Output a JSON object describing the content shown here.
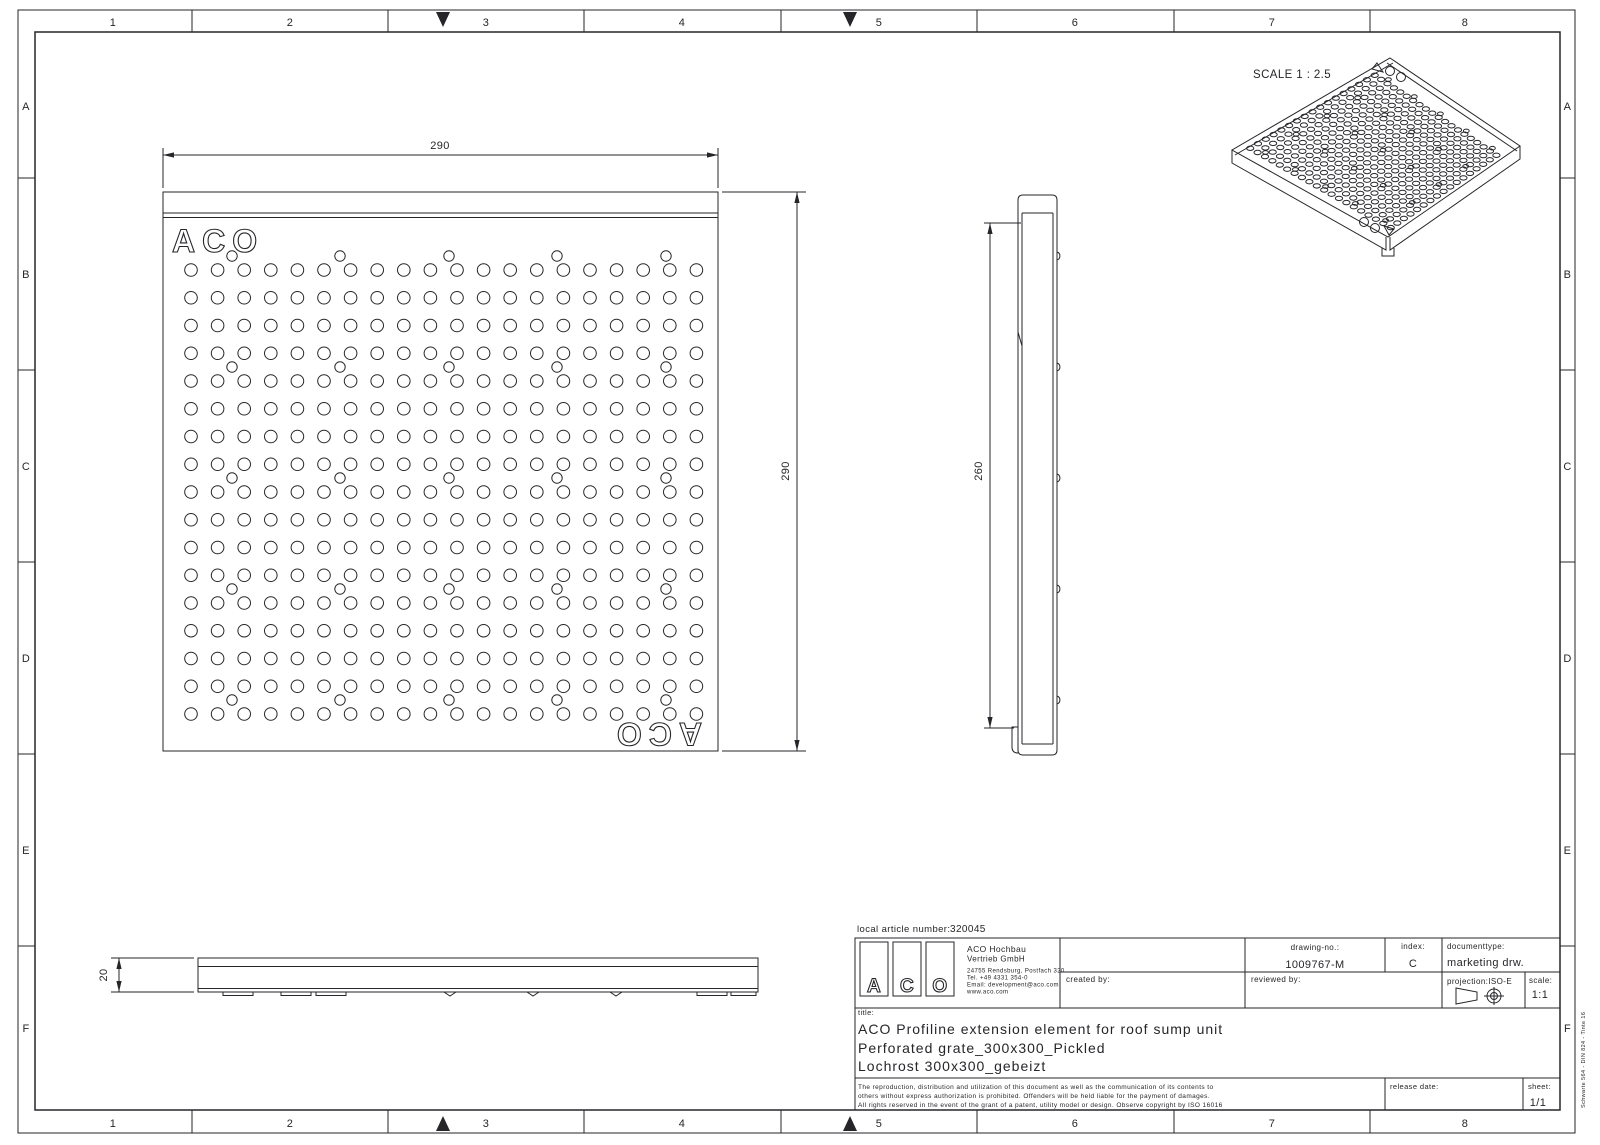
{
  "border": {
    "columns": [
      "1",
      "2",
      "3",
      "4",
      "5",
      "6",
      "7",
      "8"
    ],
    "rows": [
      "A",
      "B",
      "C",
      "D",
      "E",
      "F"
    ]
  },
  "iso_view": {
    "scale_label": "SCALE 1 : 2.5"
  },
  "plan_view": {
    "logo_text": "ACO",
    "width_dim": "290",
    "height_dim": "290"
  },
  "side_view": {
    "height_dim": "260"
  },
  "front_view": {
    "thickness_dim": "20"
  },
  "title_block": {
    "article_label": "local article number:",
    "article_value": "320045",
    "logo_letters": [
      "A",
      "C",
      "O"
    ],
    "company_line1": "ACO Hochbau",
    "company_line2": "Vertrieb GmbH",
    "address_lines": [
      "24755 Rendsburg, Postfach 320",
      "Tel. +49 4331 354-0",
      "Email: development@aco.com",
      "www.aco.com"
    ],
    "created_label": "created by:",
    "reviewed_label": "reviewed by:",
    "drawing_no_label": "drawing-no.:",
    "drawing_no": "1009767-M",
    "index_label": "index:",
    "index_value": "C",
    "doctype_label": "documenttype:",
    "doctype_value": "marketing drw.",
    "projection_label": "projection:ISO-E",
    "scale_label": "scale:",
    "scale_value": "1:1",
    "title_label": "title:",
    "title_lines": [
      "ACO Profiline extension element for roof sump unit",
      "Perforated grate_300x300_Pickled",
      "Lochrost 300x300_gebeizt"
    ],
    "legal_lines": [
      "The reproduction, distribution and utilization of this document as well as the communication of its contents to",
      "others without express authorization is prohibited. Offenders will be held liable for the payment of damages.",
      "All rights reserved in the event of the grant of a patent, utility model or design. Observe copyright by ISO 16016"
    ],
    "release_label": "release date:",
    "sheet_label": "sheet:",
    "sheet_value": "1/1"
  },
  "stamp": "Schwarte 564 - DIN 824 - Tinte 16",
  "geometry": {
    "plan": {
      "x": 163,
      "y": 192,
      "w": 555,
      "h": 559,
      "cols": 20,
      "col_start": 191,
      "col_pitch": 26.6,
      "rows": 17,
      "row_start": 270,
      "row_pitch": 27.75,
      "hole_r": 6.3,
      "extra_r": 5.2,
      "extra_xs": [
        232,
        340,
        449,
        557,
        666
      ],
      "extra_ys": [
        256,
        367,
        478,
        589,
        700
      ]
    },
    "iso": {
      "T": [
        1390,
        58
      ],
      "R": [
        1520,
        146
      ],
      "B": [
        1388,
        237
      ],
      "L": [
        1232,
        150
      ],
      "rx": 3.6,
      "ry": 2.2,
      "extra_rx": 2.9,
      "extra_ry": 1.8
    }
  }
}
